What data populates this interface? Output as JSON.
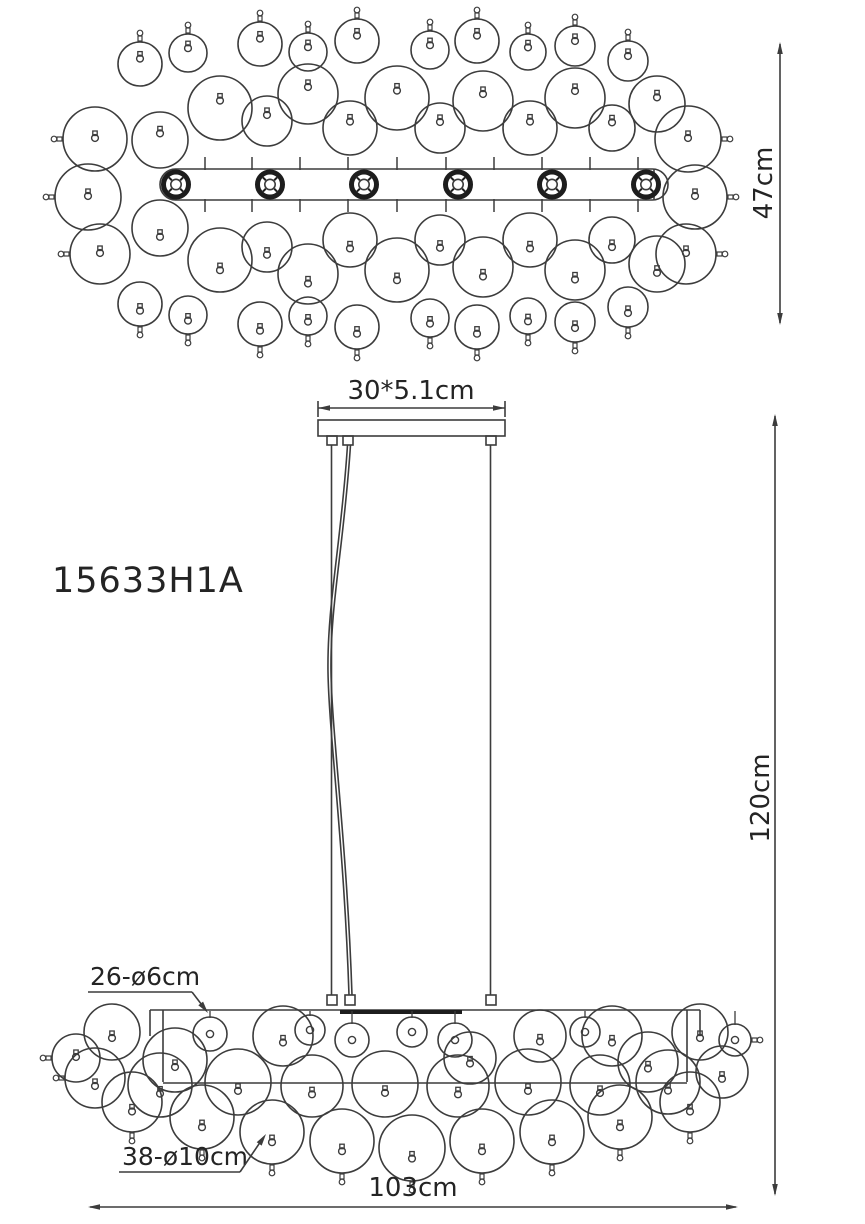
{
  "model_number": "15633H1A",
  "colors": {
    "line": "#3c3c3c",
    "dark": "#1d1d1d",
    "text": "#242424",
    "background": "#ffffff"
  },
  "top_view": {
    "height_dim": "47cm",
    "socket_count": 6
  },
  "front_view": {
    "canopy_dim": "30*5.1cm",
    "drop_dim": "120cm",
    "width_dim": "103cm",
    "small_discs_label": "26-ø6cm",
    "large_discs_label": "38-ø10cm"
  }
}
